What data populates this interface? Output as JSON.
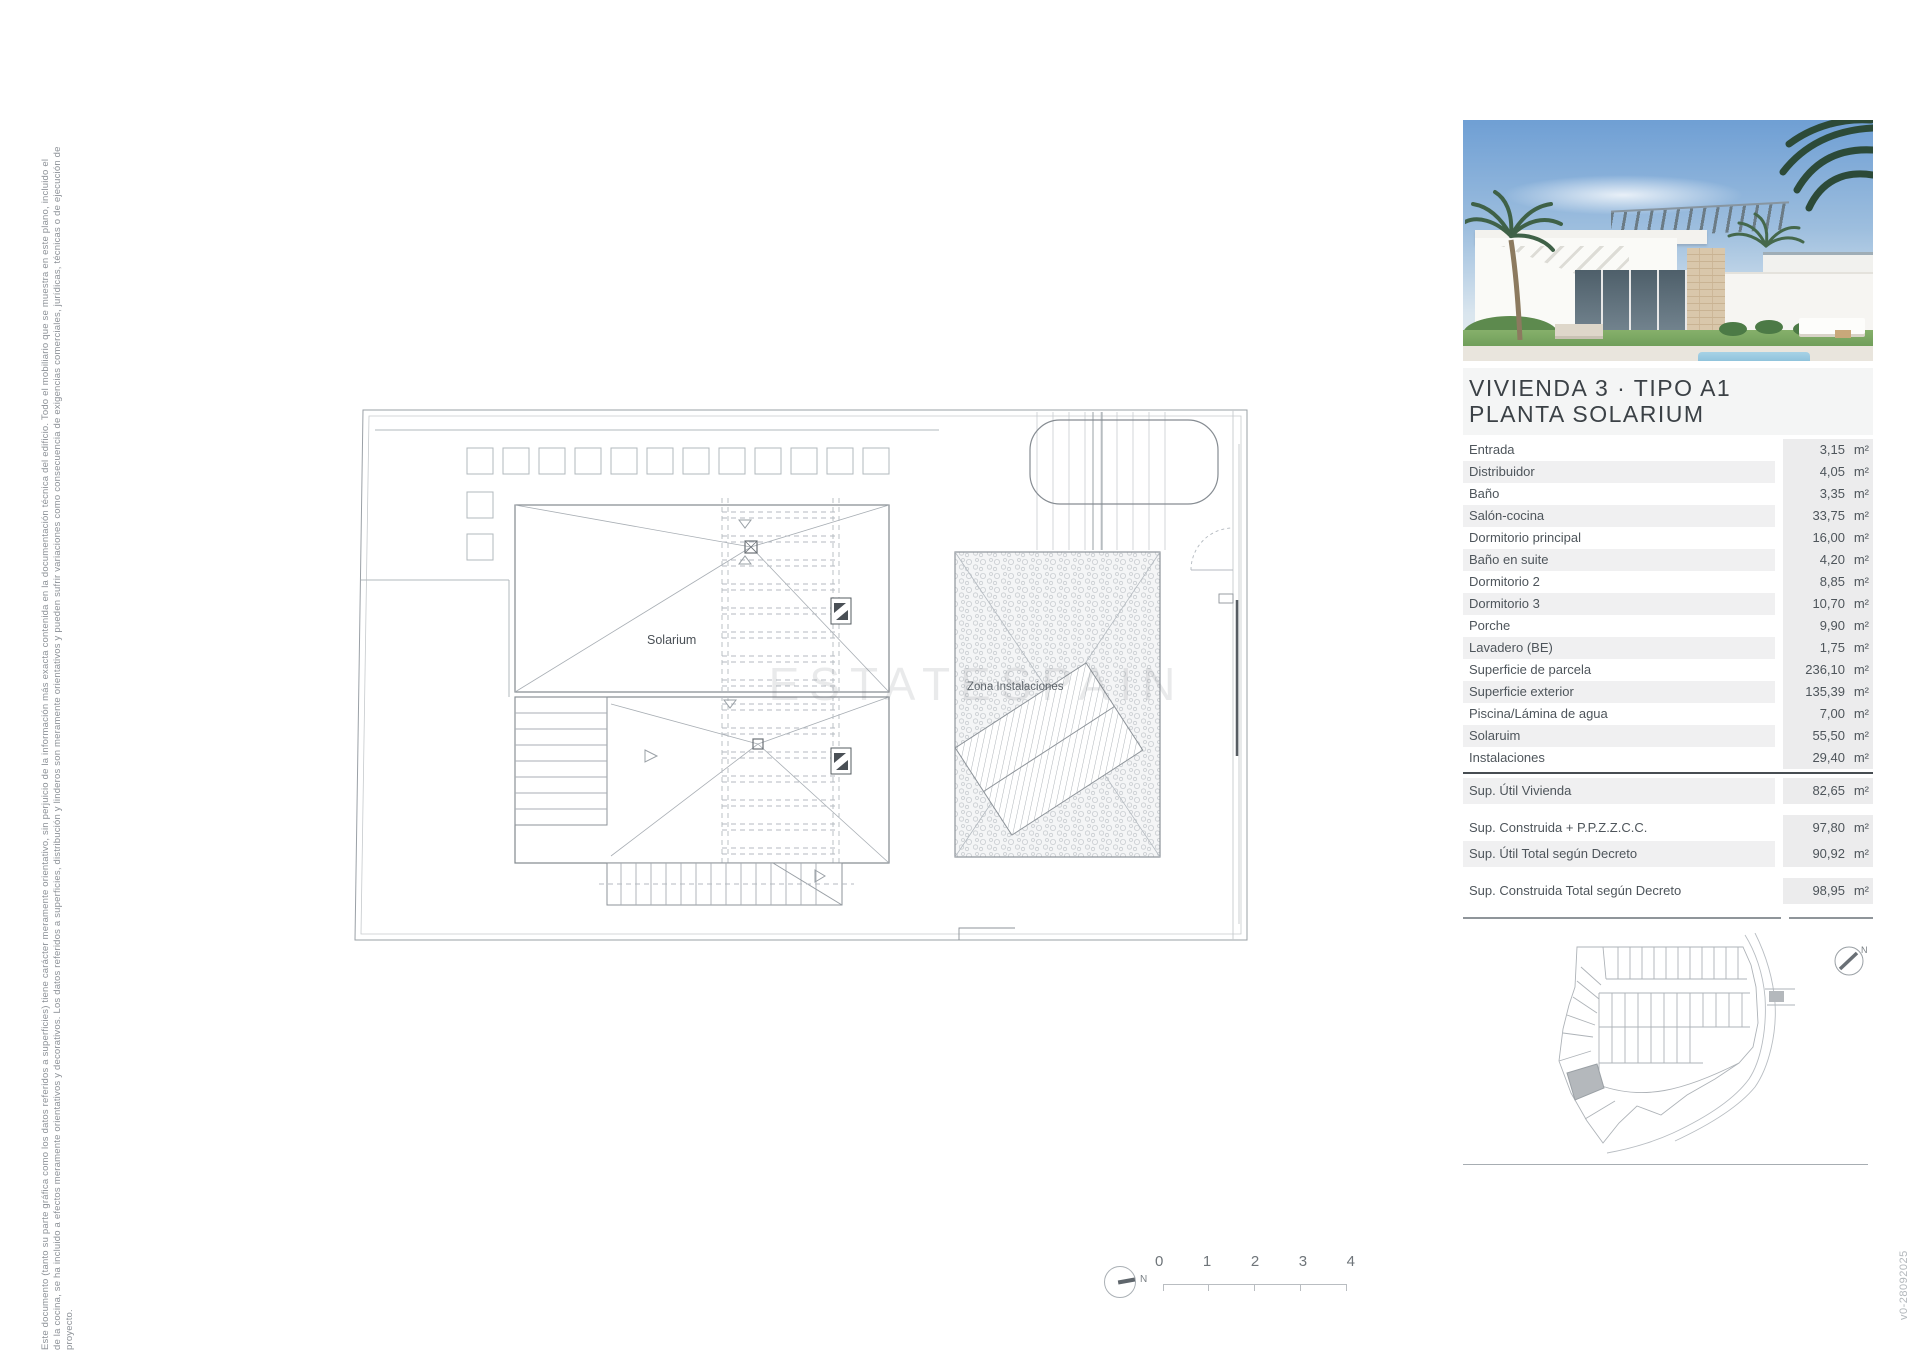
{
  "disclaimer": {
    "lines": [
      "Este documento (tanto su parte gráfica como los datos referidos a superficies) tiene carácter meramente orientativo, sin perjuicio de la información más exacta contenida en la documentación técnica del edificio. Todo el mobiliario que se muestra en este plano, incluido el",
      "de la cocina, se ha incluido a efectos meramente orientativos y decorativos. Los datos referidos a superficies, distribución y linderos son meramente orientativos y pueden sufrir variaciones como consecuencia de exigencias comerciales, jurídicas, técnicas o de ejecución de",
      "proyecto."
    ]
  },
  "version_label": "v0-28092025",
  "floor_plan": {
    "solarium_label": "Solarium",
    "instalaciones_label": "Zona Instalaciones",
    "watermark": "ESTATESPAIN"
  },
  "scale_bar": {
    "ticks": [
      "0",
      "1",
      "2",
      "3",
      "4"
    ],
    "north_label": "N"
  },
  "panel": {
    "title_line1": "VIVIENDA 3 · TIPO A1",
    "title_line2": "PLANTA SOLARIUM",
    "unit": "m²",
    "rows": [
      {
        "label": "Entrada",
        "value": "3,15"
      },
      {
        "label": "Distribuidor",
        "value": "4,05"
      },
      {
        "label": "Baño",
        "value": "3,35"
      },
      {
        "label": "Salón-cocina",
        "value": "33,75"
      },
      {
        "label": "Dormitorio principal",
        "value": "16,00"
      },
      {
        "label": "Baño en suite",
        "value": "4,20"
      },
      {
        "label": "Dormitorio 2",
        "value": "8,85"
      },
      {
        "label": "Dormitorio 3",
        "value": "10,70"
      },
      {
        "label": "Porche",
        "value": "9,90"
      },
      {
        "label": "Lavadero (BE)",
        "value": "1,75"
      },
      {
        "label": "Superficie de parcela",
        "value": "236,10"
      },
      {
        "label": "Superficie exterior",
        "value": "135,39"
      },
      {
        "label": "Piscina/Lámina de agua",
        "value": "7,00"
      },
      {
        "label": "Solaruim",
        "value": "55,50"
      },
      {
        "label": "Instalaciones",
        "value": "29,40"
      }
    ],
    "totals": [
      {
        "label": "Sup. Útil Vivienda",
        "value": "82,65"
      },
      {
        "label": "Sup. Construida + P.P.Z.Z.C.C.",
        "value": "97,80"
      },
      {
        "label": "Sup. Útil Total según Decreto",
        "value": "90,92"
      },
      {
        "label": "Sup. Construida Total según Decreto",
        "value": "98,95"
      }
    ]
  },
  "site_map": {
    "north_label": "N"
  },
  "colors": {
    "row_band": "#f0f0f1",
    "value_band": "#ececed",
    "title_text": "#3b4146",
    "plan_line": "#9aa0a6",
    "highlight_lot": "#b4b8bc"
  }
}
